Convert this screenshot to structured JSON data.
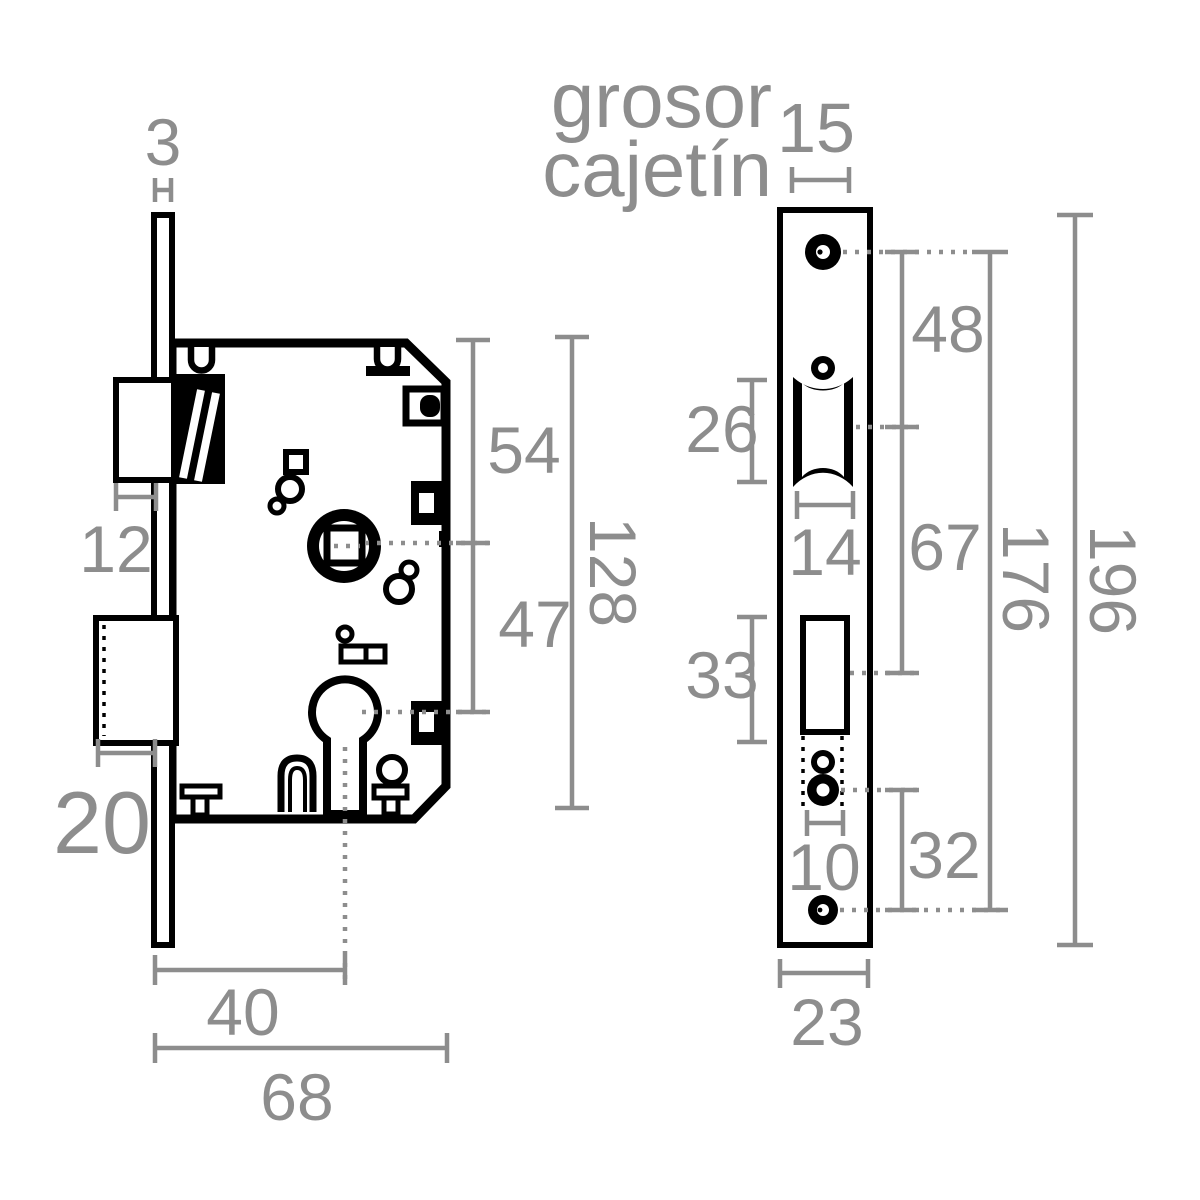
{
  "drawing": {
    "background": "#ffffff",
    "part_line_color": "#000000",
    "dimension_color": "#8d8d8d"
  },
  "annotations": {
    "thickness_label_line1": "grosor",
    "thickness_label_line2": "cajetín",
    "case_thickness": "15"
  },
  "side_view": {
    "faceplate_thickness": "3",
    "latch_projection": "12",
    "deadbolt_projection": "20",
    "top_to_spindle": "54",
    "spindle_to_cylinder": "47",
    "case_height": "128",
    "backset": "40",
    "case_depth": "68"
  },
  "front_view": {
    "screw_to_latch": "48",
    "latch_cutout_height": "26",
    "latch_cutout_width": "14",
    "latch_to_deadbolt": "67",
    "deadbolt_cutout_height": "33",
    "cylinder_hole_width": "10",
    "cylinder_to_bottom_screw": "32",
    "screw_spacing": "176",
    "faceplate_height": "196",
    "faceplate_width": "23"
  }
}
